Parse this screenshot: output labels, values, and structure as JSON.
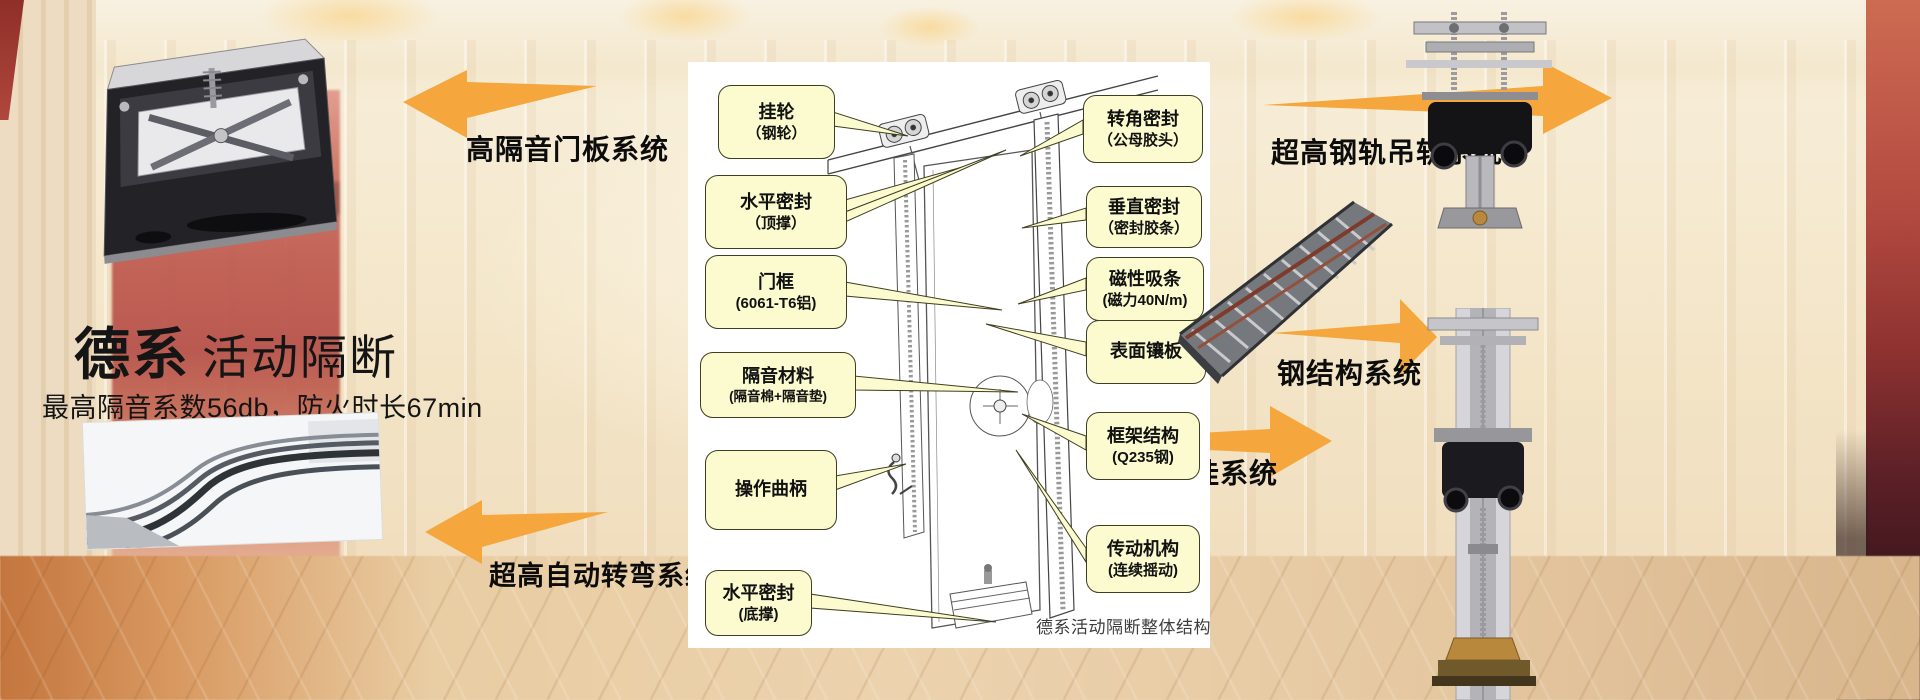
{
  "hero": {
    "brand": "德系",
    "product": "活动隔断",
    "subtitle": "最高隔音系数56db，防火时长67min"
  },
  "system_labels": {
    "door_panel": "高隔音门板系统",
    "auto_turn": "超高自动转弯系统",
    "steel_rail": "超高钢轨吊轨系统",
    "steel_structure": "钢结构系统",
    "alu_rail": "超高铝轨吊挂系统"
  },
  "diagram": {
    "caption": "德系活动隔断整体结构",
    "callouts_left": [
      {
        "line1": "挂轮",
        "line2": "（钢轮）"
      },
      {
        "line1": "水平密封",
        "line2": "（顶撑）"
      },
      {
        "line1": "门框",
        "line2": "(6061-T6铝)"
      },
      {
        "line1": "隔音材料",
        "line2": "(隔音棉+隔音垫)"
      },
      {
        "line1": "操作曲柄",
        "line2": ""
      },
      {
        "line1": "水平密封",
        "line2": "(底撑)"
      }
    ],
    "callouts_right": [
      {
        "line1": "转角密封",
        "line2": "（公母胶头）"
      },
      {
        "line1": "垂直密封",
        "line2": "（密封胶条）"
      },
      {
        "line1": "磁性吸条",
        "line2": "(磁力40N/m)"
      },
      {
        "line1": "表面镶板",
        "line2": ""
      },
      {
        "line1": "框架结构",
        "line2": "(Q235钢)"
      },
      {
        "line1": "传动机构",
        "line2": "(连续摇动)"
      }
    ]
  },
  "colors": {
    "arrow_orange": "#F5A63C",
    "callout_fill": "#FBFBCF",
    "callout_border": "#3E3E20",
    "panel_white": "#FFFFFF"
  }
}
